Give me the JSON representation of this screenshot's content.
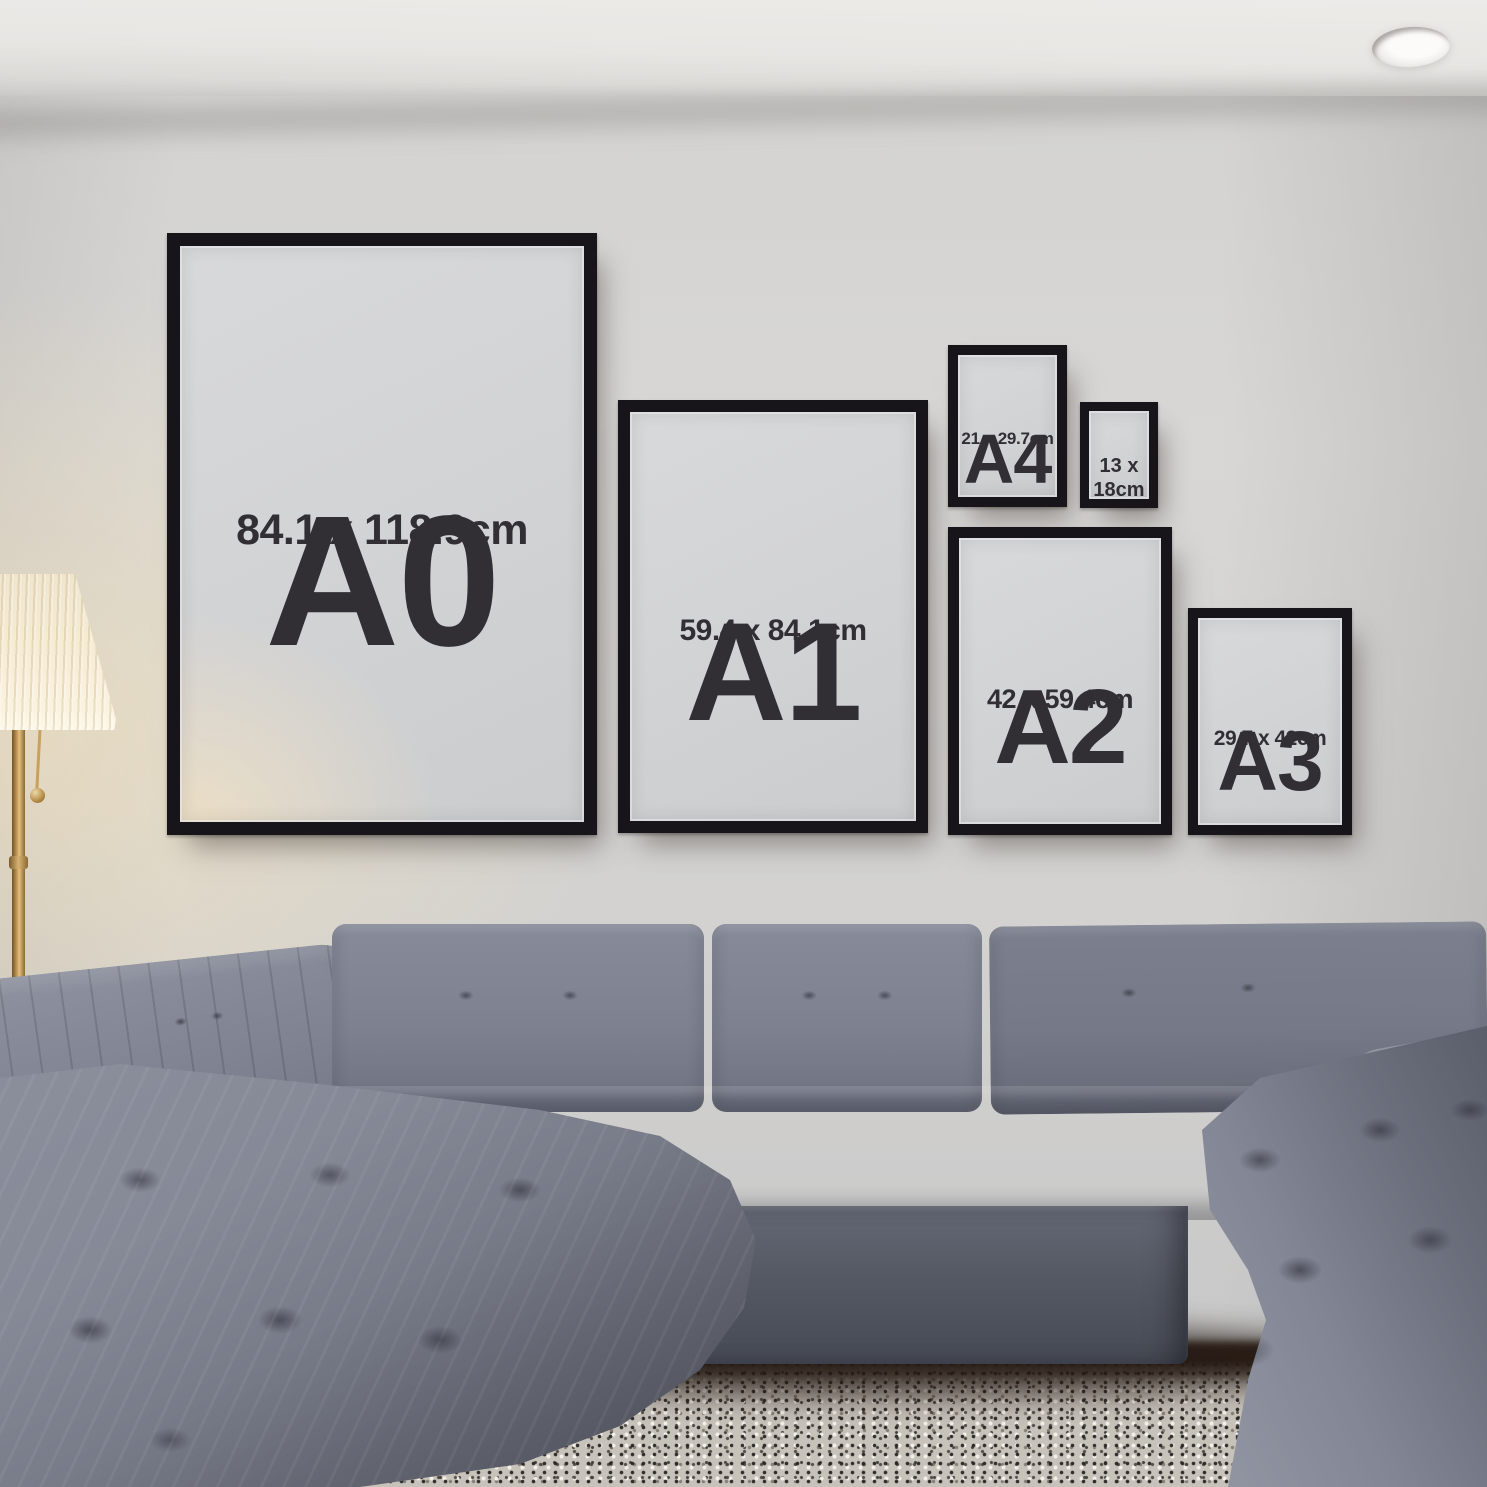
{
  "frames": [
    {
      "id": "a0",
      "code": "A0",
      "size": "84.1 x 118.9cm"
    },
    {
      "id": "a1",
      "code": "A1",
      "size": "59.4 x 84.1cm"
    },
    {
      "id": "a4",
      "code": "A4",
      "size": "21 x 29.7cm"
    },
    {
      "id": "s13x18",
      "code": "",
      "size": "13 x 18cm"
    },
    {
      "id": "a2",
      "code": "A2",
      "size": "42 x 59.4cm"
    },
    {
      "id": "a3",
      "code": "A3",
      "size": "29.7 x 42cm"
    }
  ],
  "colors": {
    "frame": "#18151a",
    "poster_paper": "#d2d3d5",
    "poster_text": "#312f33",
    "wall": "#d5d4d2",
    "ceiling": "#eceae7",
    "lamp_glow": "#f8e4b9",
    "lamp_shade": "#f6ecd4",
    "lamp_brass": "#c89c58",
    "sofa_grey": "#7d8190",
    "sofa_shadow": "#4c4f59",
    "rug": "#c7c2ba",
    "floor": "#33221b"
  }
}
